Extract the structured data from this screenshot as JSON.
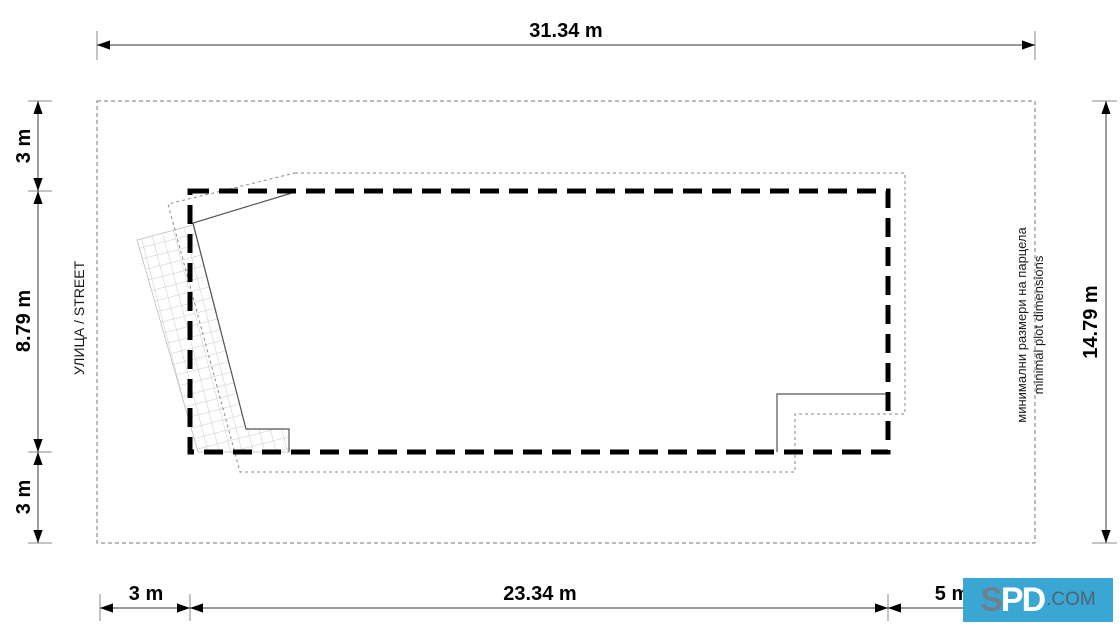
{
  "diagram": {
    "title_note": {
      "line1": "минимални размери на парцела",
      "line2": "minimal plot dimensions"
    },
    "street_label": "УЛИЦА / STREET",
    "dimensions": {
      "top": "31.34 m",
      "left_top": "3 m",
      "left_middle": "8.79 m",
      "left_bottom": "3 m",
      "right": "14.79 m",
      "bottom_left": "3 m",
      "bottom_middle": "23.34 m",
      "bottom_right": "5 m"
    },
    "measurements_m": {
      "plot_width": 31.34,
      "plot_height": 14.79,
      "setback_top": 3,
      "building_height": 8.79,
      "setback_bottom": 3,
      "setback_left": 3,
      "building_width": 23.34,
      "setback_right": 5
    },
    "watermark": {
      "logo_first": "S",
      "logo_rest": "PD",
      "suffix": ".COM",
      "bg_color": "#3aa6d4"
    },
    "colors": {
      "envelope": "#000000",
      "plot_boundary": "#909090",
      "eaves_outline": "#8a8a8a",
      "house_outline": "#555555",
      "hatch": "#c9c9c9",
      "dim_line": "#5a5a5a"
    }
  }
}
